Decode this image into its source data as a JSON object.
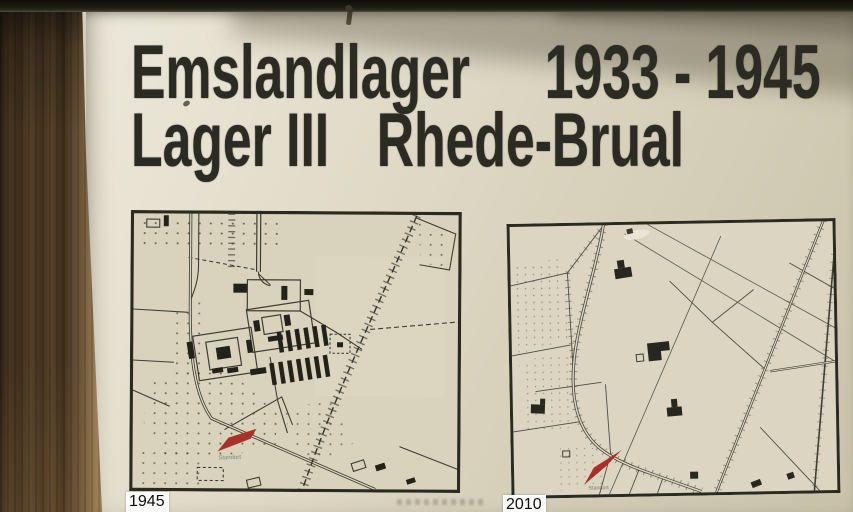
{
  "sign": {
    "title": {
      "line1_left": "Emslandlager",
      "line1_right": "1933 - 1945",
      "line2_left": "Lager III",
      "line2_right": "Rhede-Brual"
    },
    "maps": {
      "left": {
        "year_label": "1945",
        "marker_label": "Standort"
      },
      "right": {
        "year_label": "2010",
        "marker_label": "Standort"
      }
    },
    "colors": {
      "board": "#dcd6c2",
      "title_ink": "#2b2a23",
      "map_ink": "#3f3d30",
      "marker_red": "#a8322a",
      "year_label_bg": "#fcfcfa",
      "wood_post": "#4a3723"
    }
  }
}
